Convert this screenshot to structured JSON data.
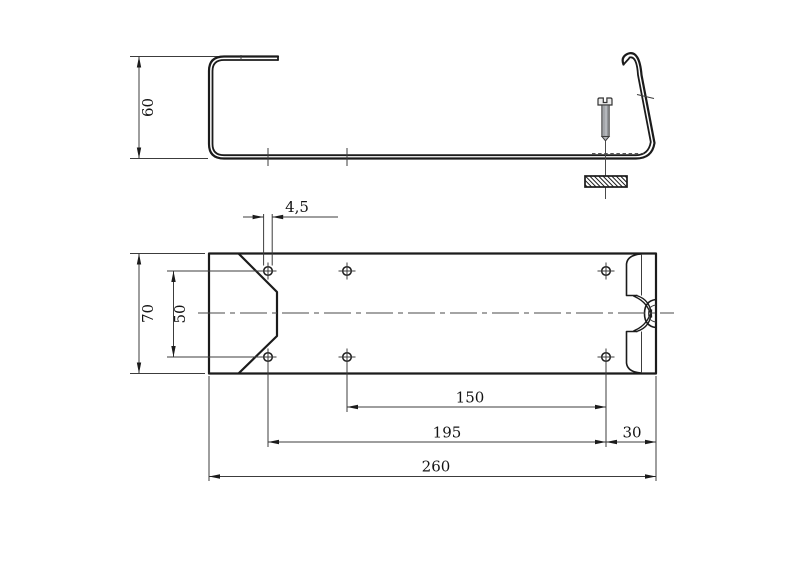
{
  "canvas": {
    "background": "#ffffff",
    "line_color": "#1b1b1b"
  },
  "views": {
    "side": {
      "dimensions": {
        "height": "60"
      }
    },
    "plan": {
      "hole_count": 6,
      "dimensions": {
        "hole_diameter": "4,5",
        "hole_row_spacing": "50",
        "plate_width": "70",
        "mid_to_right_holes": "150",
        "left_to_right_holes": "195",
        "right_hole_to_edge": "30",
        "total_length": "260"
      }
    }
  }
}
